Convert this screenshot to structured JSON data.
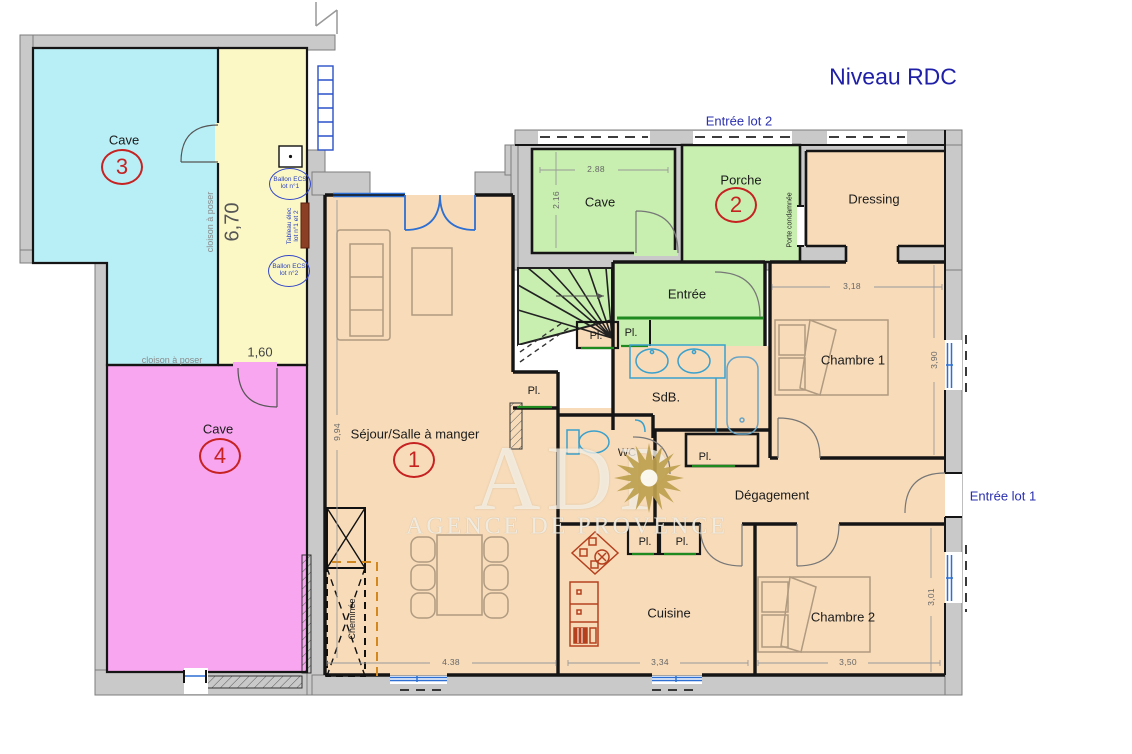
{
  "title": "Niveau RDC",
  "watermark": {
    "brand": "ADP",
    "subtitle": "AGENCE DE PROVENCE"
  },
  "labels": {
    "entree_lot_1": "Entrée lot 1",
    "entree_lot_2": "Entrée lot 2",
    "cave": "Cave",
    "cave3_num": "3",
    "cave4_num": "4",
    "porche": "Porche",
    "porche_num": "2",
    "sejour": "Séjour/Salle à manger",
    "sejour_num": "1",
    "dressing": "Dressing",
    "entree": "Entrée",
    "chambre1": "Chambre 1",
    "chambre2": "Chambre 2",
    "sdb": "SdB.",
    "wc": "WC",
    "degagement": "Dégagement",
    "cuisine": "Cuisine",
    "placard": "Pl.",
    "cheminee": "Cheminée",
    "porte_condamnee": "Porte condamnée",
    "cloison": "cloison à poser",
    "ballon1": "Ballon ECS lot n°1",
    "ballon2": "Ballon ECS lot n°2",
    "tableau": "Tableau élec lot n°1 et 2"
  },
  "dimensions": {
    "corridor_h": "6,70",
    "corridor_w": "1,60",
    "sejour_h": "9,94",
    "sejour_w": "4.38",
    "cave2_w": "2.88",
    "cave2_h": "2.16",
    "chambre1_w": "3,18",
    "chambre1_h": "3,90",
    "cuisine_w": "3,34",
    "chambre2_w": "3,50",
    "chambre2_h": "3,01"
  },
  "colors": {
    "cave3_cyan": "#b8eef5",
    "corridor_yellow": "#fbf8c6",
    "cave4_magenta": "#f7a6ef",
    "lot2_green": "#c8efb0",
    "floor_peach": "#f8dcba",
    "wall_gray": "#c9c9c9",
    "accent_blue": "#2a2fae",
    "marker_red": "#c62222",
    "window_blue": "#2d6fd2",
    "sun_gold": "#bda04e"
  }
}
